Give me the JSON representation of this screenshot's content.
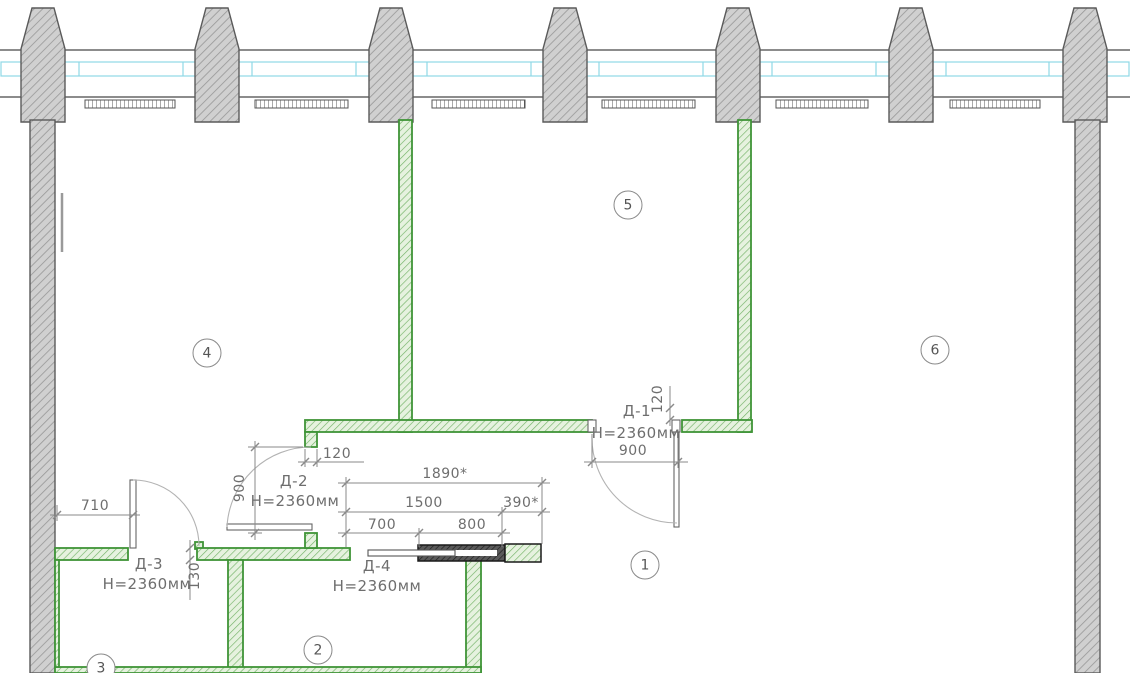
{
  "plan": {
    "rooms": [
      {
        "number": "1"
      },
      {
        "number": "2"
      },
      {
        "number": "3"
      },
      {
        "number": "4"
      },
      {
        "number": "5"
      },
      {
        "number": "6"
      }
    ],
    "doors": {
      "d1": {
        "id": "Д-1",
        "height": "H=2360мм",
        "width": "900",
        "jamb": "120"
      },
      "d2": {
        "id": "Д-2",
        "height": "H=2360мм",
        "width": "900",
        "jamb": "120"
      },
      "d3": {
        "id": "Д-3",
        "height": "H=2360мм",
        "offset": "710",
        "thickness": "130"
      },
      "d4": {
        "id": "Д-4",
        "height": "H=2360мм",
        "total": "1890*",
        "chain": "1500",
        "pocket": "390*",
        "leaf": "700",
        "cassette": "800"
      }
    },
    "colors": {
      "new_partition": "#3f9437",
      "existing_structure": "#d0d0d0",
      "window_glazing": "#8fd8e6",
      "dimension_text": "#6e6e6e"
    }
  }
}
